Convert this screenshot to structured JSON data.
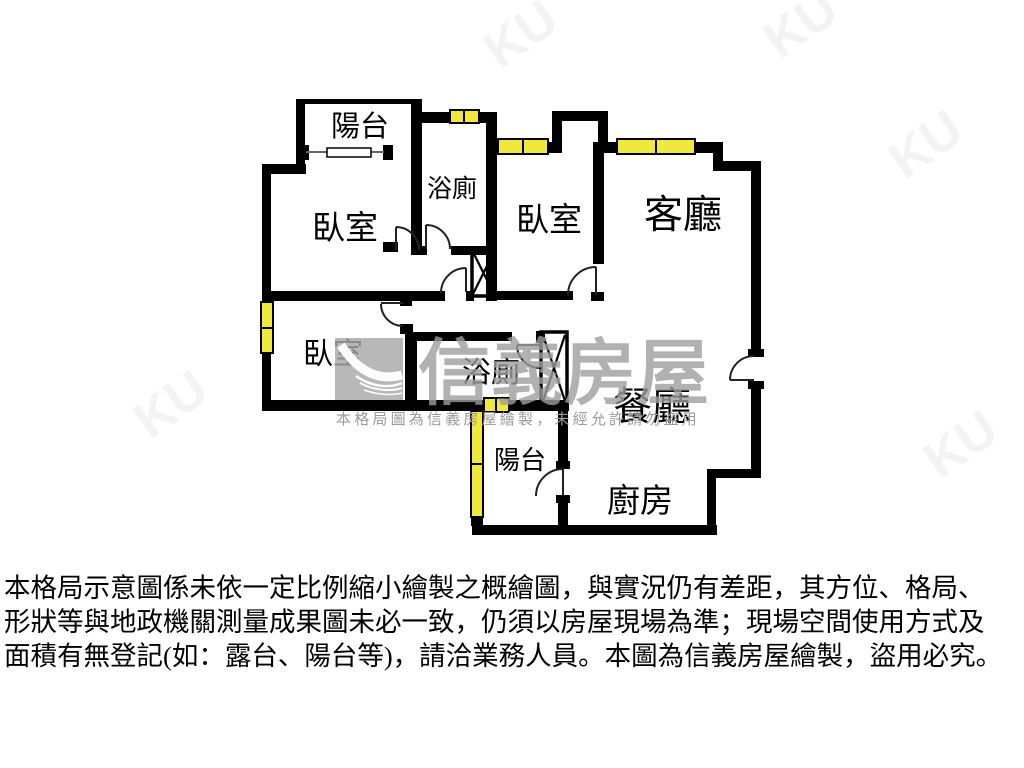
{
  "plan": {
    "rooms": [
      {
        "name": "balcony-top",
        "label": "陽台"
      },
      {
        "name": "bedroom-1",
        "label": "臥室"
      },
      {
        "name": "bathroom-1",
        "label": "浴廁"
      },
      {
        "name": "bedroom-2",
        "label": "臥室"
      },
      {
        "name": "living-room",
        "label": "客廳"
      },
      {
        "name": "bedroom-3",
        "label": "臥室"
      },
      {
        "name": "bathroom-2",
        "label": "浴廁"
      },
      {
        "name": "dining-room",
        "label": "餐廳"
      },
      {
        "name": "balcony-bottom",
        "label": "陽台"
      },
      {
        "name": "kitchen",
        "label": "廚房"
      }
    ],
    "colors": {
      "wall": "#000000",
      "window_fill": "#f0e83c",
      "window_border": "#000000",
      "background": "#ffffff",
      "watermark_gray": "#9e9e9e"
    }
  },
  "watermark": {
    "brand": "信義房屋",
    "notice": "本格局圖為信義房屋繪製，未經允許請勿盜用"
  },
  "disclaimer": {
    "lines": [
      "本格局示意圖係未依一定比例縮小繪製之概繪圖，與實況仍有差距，其方位、格局、",
      "形狀等與地政機關測量成果圖未必一致，仍須以房屋現場為準；現場空間使用方式及",
      "面積有無登記(如：露台、陽台等)，請洽業務人員。本圖為信義房屋繪製，盜用必究。"
    ]
  }
}
